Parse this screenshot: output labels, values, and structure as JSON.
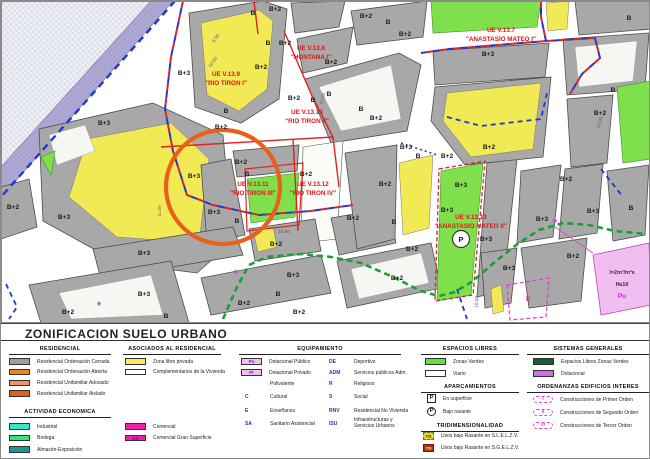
{
  "legend": {
    "title": "ZONIFICACION SUELO URBANO",
    "residencial": {
      "header": "RESIDENCIAL",
      "items": [
        {
          "color": "#9f9f9f",
          "label": "Residencial Ordenación Cerrada"
        },
        {
          "color": "#e8871d",
          "label": "Residencial Ordenación Abierta"
        },
        {
          "color": "#f4906a",
          "label": "Residencial Unifamiliar Adosado"
        },
        {
          "color": "#e55a1e",
          "label": "Residencial Unifamiliar Aislado"
        }
      ]
    },
    "actividad": {
      "header": "ACTIVIDAD ECONOMICA",
      "items": [
        {
          "color": "#35e6c8",
          "label": "Industrial"
        },
        {
          "color": "#35e67a",
          "label": "Bodega"
        },
        {
          "color": "#1b9a93",
          "label": "Almacén-Exposición"
        }
      ],
      "items_comercial": [
        {
          "color": "#ee22aa",
          "label": "Comercial"
        },
        {
          "color": "#ee22aa",
          "label": "Comercial Gran Superficie",
          "badge": "GS"
        }
      ]
    },
    "asociados": {
      "header": "ASOCIADOS AL RESIDENCIAL",
      "items": [
        {
          "color": "#f5ee55",
          "label": "Zona libre privada"
        },
        {
          "color": "#ffffff",
          "label": "Complementarios de la Vivienda"
        }
      ]
    },
    "equipamiento": {
      "header": "EQUIPAMIENTO",
      "swatch_items": [
        {
          "color": "#efc2ee",
          "code": "Pu",
          "label": "Dotacional Público"
        },
        {
          "color": "#efc2ee",
          "code": "Pr",
          "label": "Dotacional Privado"
        }
      ],
      "codes_left": [
        {
          "code": "",
          "label": "Polivalente"
        },
        {
          "code": "C",
          "label": "Cultural"
        },
        {
          "code": "E",
          "label": "Enseñanza"
        },
        {
          "code": "SA",
          "label": "Sanitario Asistencial"
        }
      ],
      "codes_right": [
        {
          "code": "DE",
          "label": "Deportivo"
        },
        {
          "code": "ADM",
          "label": "Servicios públicos Adm."
        },
        {
          "code": "R",
          "label": "Religioso"
        },
        {
          "code": "S",
          "label": "Social"
        },
        {
          "code": "RNV",
          "label": "Residencial No Vivienda"
        },
        {
          "code": "ISU",
          "label": "Infraestructuras y Servicios Urbanos",
          "wrap": true
        }
      ]
    },
    "espacios": {
      "header": "ESPACIOS LIBRES",
      "items": [
        {
          "color": "#66e23e",
          "label": "Zonas Verdes"
        },
        {
          "color": "#ffffff",
          "label": "Viario"
        }
      ]
    },
    "aparcamientos": {
      "header": "APARCAMIENTOS",
      "items": [
        {
          "shape": "square",
          "letter": "P",
          "label": "En superficie"
        },
        {
          "shape": "circle",
          "letter": "P",
          "label": "Bajo rasante"
        }
      ]
    },
    "tridimensionalidad": {
      "header": "TRIDIMENSIONALIDAD",
      "items": [
        {
          "code": "TR",
          "style": "tr1",
          "label": "Usos bajo Rasante en S.L.E.L.Z.V."
        },
        {
          "code": "TR",
          "style": "tr2",
          "label": "Usos bajo Rasante en S.G.E.L.Z.V."
        }
      ]
    },
    "sistemas": {
      "header": "SISTEMAS GENERALES",
      "items": [
        {
          "color": "#1c5c2a",
          "label": "Espacios Libres Zonas Verdes"
        },
        {
          "color": "#cf6ee4",
          "label": "Dotacional"
        }
      ]
    },
    "ordenanzas": {
      "header": "ORDENANZAS EDIFICIOS INTERES",
      "items": [
        {
          "code": "I",
          "label": "Construcciones de Primer Orden"
        },
        {
          "code": "II",
          "label": "Construcciones de Segundo Orden"
        },
        {
          "code": "III",
          "label": "Construcciones de Tercer Orden"
        }
      ]
    }
  },
  "map": {
    "ue_labels": [
      {
        "line1": "UE V.13.9",
        "line2": "\"RIO TIRON I\"",
        "x": 225,
        "y": 75
      },
      {
        "line1": "UE V.13.8",
        "line2": "\"HONTANA I\"",
        "x": 310,
        "y": 49
      },
      {
        "line1": "UE V.13.7",
        "line2": "\"ANASTASIO MATEO I\"",
        "x": 500,
        "y": 31
      },
      {
        "line1": "UE V.13.10",
        "line2": "\"RIO TIRON II\"",
        "x": 306,
        "y": 113
      },
      {
        "line1": "UE V.13.11",
        "line2": "\"RIO TIRON III\"",
        "x": 252,
        "y": 185
      },
      {
        "line1": "UE V.13.12",
        "line2": "\"RIO TIRON IV\"",
        "x": 312,
        "y": 185
      },
      {
        "line1": "UE V.13.13",
        "line2": "\"ANASTASIO MATEO II\"",
        "x": 470,
        "y": 218
      }
    ],
    "block_labels": [
      [
        252,
        14,
        "B"
      ],
      [
        274,
        10,
        "B+2"
      ],
      [
        267,
        44,
        "B"
      ],
      [
        284,
        44,
        "B+2"
      ],
      [
        183,
        74,
        "B+3"
      ],
      [
        260,
        68,
        "B+2"
      ],
      [
        293,
        99,
        "B+2"
      ],
      [
        312,
        101,
        "B"
      ],
      [
        225,
        112,
        "B"
      ],
      [
        103,
        124,
        "B+3"
      ],
      [
        220,
        128,
        "B+2"
      ],
      [
        365,
        17,
        "B+2"
      ],
      [
        387,
        23,
        "B"
      ],
      [
        404,
        35,
        "B+2"
      ],
      [
        330,
        63,
        "B+2"
      ],
      [
        328,
        95,
        "B"
      ],
      [
        360,
        110,
        "B"
      ],
      [
        375,
        119,
        "B+2"
      ],
      [
        487,
        55,
        "B+3"
      ],
      [
        628,
        19,
        "B"
      ],
      [
        612,
        91,
        "B"
      ],
      [
        599,
        114,
        "B+2"
      ],
      [
        488,
        148,
        "B+2"
      ],
      [
        405,
        148,
        "B+3"
      ],
      [
        417,
        157,
        "B"
      ],
      [
        446,
        157,
        "B+2"
      ],
      [
        12,
        208,
        "B+2"
      ],
      [
        63,
        218,
        "B+3"
      ],
      [
        193,
        177,
        "B+3"
      ],
      [
        240,
        163,
        "B+2"
      ],
      [
        246,
        175,
        "B"
      ],
      [
        305,
        175,
        "B+2"
      ],
      [
        213,
        213,
        "B+3"
      ],
      [
        236,
        222,
        "B"
      ],
      [
        275,
        245,
        "B+2"
      ],
      [
        143,
        254,
        "B+3"
      ],
      [
        292,
        276,
        "B+3"
      ],
      [
        277,
        295,
        "B"
      ],
      [
        67,
        313,
        "B+2"
      ],
      [
        165,
        317,
        "B"
      ],
      [
        143,
        295,
        "B+3"
      ],
      [
        243,
        304,
        "B+2"
      ],
      [
        298,
        313,
        "B+2"
      ],
      [
        352,
        219,
        "B+2"
      ],
      [
        393,
        223,
        "B"
      ],
      [
        384,
        185,
        "B+2"
      ],
      [
        460,
        186,
        "B+3"
      ],
      [
        446,
        211,
        "B+3"
      ],
      [
        485,
        240,
        "B+3"
      ],
      [
        411,
        250,
        "B+2"
      ],
      [
        396,
        279,
        "B+2"
      ],
      [
        508,
        269,
        "B+3"
      ],
      [
        541,
        220,
        "B+3"
      ],
      [
        565,
        180,
        "B+2"
      ],
      [
        592,
        212,
        "B+3"
      ],
      [
        630,
        209,
        "B"
      ],
      [
        572,
        257,
        "B+2"
      ]
    ],
    "dim_labels": [
      [
        213,
        62,
        -55,
        "10.00"
      ],
      [
        323,
        98,
        -78,
        "10.00"
      ],
      [
        283,
        232,
        0,
        "10.00"
      ],
      [
        160,
        210,
        -90,
        "11.00"
      ],
      [
        477,
        301,
        -85,
        "10.00"
      ],
      [
        600,
        122,
        -72,
        "10.00"
      ],
      [
        216,
        38,
        -55,
        "5.00"
      ]
    ],
    "special_labels": [
      {
        "text": "I=2m³/m²s",
        "x": 621,
        "y": 273,
        "cls": "zone-spec-label"
      },
      {
        "text": "H≤10",
        "x": 621,
        "y": 285,
        "cls": "zone-spec-label"
      },
      {
        "text": "Pu",
        "x": 621,
        "y": 297,
        "cls": "pu-label"
      },
      {
        "text": "II",
        "x": 527,
        "y": 300,
        "cls": "orden-ii-label"
      }
    ],
    "asterisk_symbol": "*",
    "asterisks": [
      {
        "x": 98,
        "y": 308
      },
      {
        "x": 235,
        "y": 276
      },
      {
        "x": 554,
        "y": 225
      }
    ],
    "parking_letter": "P"
  }
}
